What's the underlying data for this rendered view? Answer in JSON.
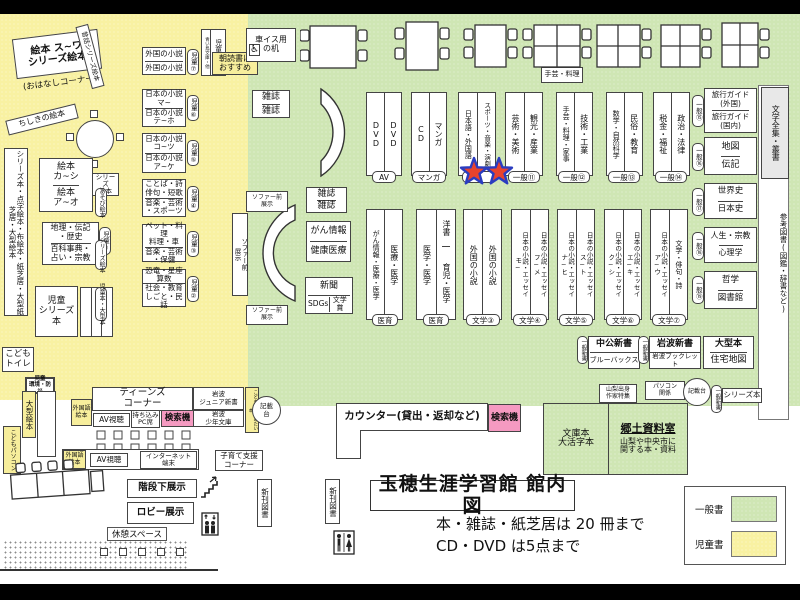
{
  "colors": {
    "general_zone": "#cfe6b4",
    "children_zone": "#f8f1a2",
    "search_pink": "#f59ac1",
    "star_red": "#e8432e",
    "star_blue": "#2a3cc0"
  },
  "title": {
    "main": "玉穂生涯学習館 館内図",
    "rule1": "本・雑誌・紙芝居は 20 冊まで",
    "rule2": "CD・DVD は5点まで"
  },
  "legend": {
    "general": "一般書",
    "children": "児童書"
  },
  "story": {
    "shelf": "絵本 ス~ワ\nシリーズ絵本",
    "corner": "(おはなしコーナー)",
    "mukashi": "昔話シリーズ絵本",
    "chishiki": "ちしきの絵本"
  },
  "left": {
    "strip": "シリーズ本・点字絵本・布絵本・紙芝居・大型紙芝居・大型絵本",
    "ehon_ka": "絵本\nカ~シ",
    "ehon_a": "絵本\nア~オ",
    "series": "シリーズ\n絵本",
    "chiri": "地理・伝記\n・歴史",
    "hyakka": "百科事典・\n占い・宗教",
    "badge": "児童①",
    "jido_series": "児童\nシリーズ本",
    "toilet": "こども\nトイレ",
    "kankyo": "児童\n環境・防災",
    "ogata": "大型絵本",
    "pc": "こどもパソコン"
  },
  "kids": {
    "shinsho": "児童新書",
    "shinsho_sub": "青い鳥文庫・他",
    "asadoku": "朝読書に\nおすすめ",
    "susume": "こどもにすすめたい本",
    "blocks": [
      {
        "top": "外国の小説",
        "bottom": "外国の小説",
        "badge": "児童⑦"
      },
      {
        "top": "日本の小説\nマ~",
        "bottom": "日本の小説\nテ~ホ",
        "badge": "児童⑥"
      },
      {
        "top": "日本の小説\nコ~ツ",
        "bottom": "日本の小説\nア~ケ",
        "badge": "児童⑤"
      },
      {
        "top": "ことば・詩\n俳句・短歌",
        "bottom": "音楽・芸術\n・スポーツ",
        "badge": "児童④",
        "side": "あそび絵本"
      },
      {
        "top": "ペット・料理\n料理・車",
        "bottom": "音楽・芸術\n・保健",
        "badge": "児童③",
        "side": "シリーズ絵本"
      },
      {
        "top": "恐竜・星座\n算数",
        "bottom": "社会・教育\nしごと・民話",
        "badge": "児童②",
        "side": "児童本・大型本"
      }
    ]
  },
  "teens": {
    "header": "ティーンズ\nコーナー",
    "gaikokugo": "外国語\n絵本",
    "av": "AV視聴",
    "pc_seat": "持ち込み\nPC席",
    "kensaku": "検索機",
    "junior": "岩波\nジュニア新書",
    "shonen": "岩波\n少年文庫",
    "internet": "インターネット\n端末",
    "kosodate": "子育て支援\nコーナー"
  },
  "center": {
    "wheel_desk": "車イス用\nの机",
    "wheel_icon": "♿",
    "zasshi": "雑誌",
    "sofa": "ソファー前\n展示",
    "gan": "がん情報",
    "kenko": "健康医療",
    "shinbun": "新聞",
    "sdgs": "SDGs",
    "prize": "文学賞",
    "shugei": "手芸・料理"
  },
  "row1": [
    {
      "l": "DVD",
      "r": "DVD",
      "tag": "AV"
    },
    {
      "l": "CD",
      "r": "マンガ",
      "tag": "マンガ"
    },
    {
      "l": "日本語・外国語",
      "r": "スポーツ・音楽・演劇",
      "tag": ""
    },
    {
      "l": "芸術・美術",
      "r": "観光・産業",
      "tag": "一般⑪"
    },
    {
      "l": "手芸・料理・家事",
      "r": "技術・工業",
      "tag": "一般⑫"
    },
    {
      "l": "数学・自然科学",
      "r": "民俗・教育",
      "tag": "一般⑬"
    },
    {
      "l": "税金・福祉",
      "r": "政治・法律",
      "tag": "一般⑭"
    }
  ],
  "row2": [
    {
      "l": "がん情報・医療・医学",
      "r": "医療・医学",
      "tag": "医育"
    },
    {
      "l": "医学・医学",
      "r_top": "洋書",
      "r_bottom": "育児・医学",
      "tag": "医育"
    },
    {
      "l": "外国の小説",
      "r": "外国の小説",
      "tag": "文学③"
    },
    {
      "l": "日本の小説・エッセイ\nモ~",
      "r": "日本の小説・エッセイ\nフ~メ",
      "tag": "文学④"
    },
    {
      "l": "日本の小説・エッセイ\nナ~ヒ",
      "r": "日本の小説・エッセイ\nス~ト",
      "tag": "文学⑤"
    },
    {
      "l": "日本の小説・エッセイ\nク~シ",
      "r": "日本の小説・エッセイ\nエ~キ",
      "tag": "文学⑥"
    },
    {
      "l": "日本の小説・エッセイ\nア~ウ",
      "r": "文学・俳句・詩",
      "tag": "文学⑦"
    }
  ],
  "right_col": {
    "pairs": [
      {
        "tag": "一般⑮",
        "top": "旅行ガイド\n(外国)",
        "bottom": "旅行ガイド\n(国内)"
      },
      {
        "tag": "一般⑯",
        "top": "地図",
        "bottom": "伝記"
      },
      {
        "tag": "一般⑰",
        "top": "世界史",
        "bottom": "日本史"
      },
      {
        "tag": "一般⑱",
        "top": "人生・宗教",
        "bottom": "心理学"
      },
      {
        "tag": "一般⑲",
        "top": "哲学",
        "bottom": "図書館"
      }
    ],
    "zenshu": "文学全集・叢書",
    "sanko": "参考図書(図鑑・辞書など)"
  },
  "shinsho_row": {
    "tag": "一般新書",
    "chuko": "中公新書",
    "bluebacks": "ブルーバックス",
    "iwanami": "岩波新書",
    "booklet": "岩波ブックレット",
    "ogata": "大型本",
    "jutaku": "住宅地図",
    "yamanashi": "山梨出身\n作家特集",
    "pasokon": "パソコン\n関係",
    "kisaidai": "記載台",
    "series": "シリーズ本"
  },
  "kyodo": {
    "bunko": "文庫本\n大活字本",
    "title": "郷土資料室",
    "desc": "山梨や中央市に\n関する本・資料"
  },
  "counter": {
    "label": "カウンター(貸出・返却など)",
    "kensaku": "検索機",
    "kisaidai": "記載\n台"
  },
  "bottom": {
    "kaidan": "階段下展示",
    "lobby": "ロビー展示",
    "kyukei": "休憩スペース",
    "shinkan": "新刊図書"
  }
}
